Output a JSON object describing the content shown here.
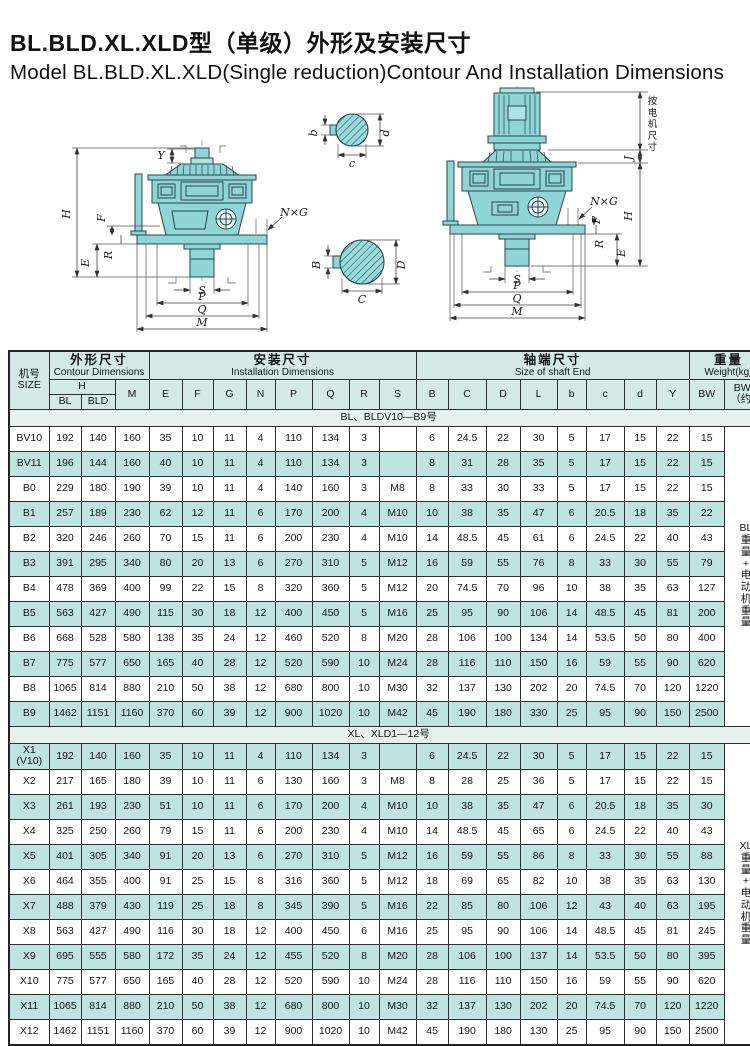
{
  "title": {
    "cn": "BL.BLD.XL.XLD型（单级）外形及安装尺寸",
    "en": "Model BL.BLD.XL.XLD(Single reduction)Contour And Installation Dimensions"
  },
  "drawings": {
    "left_view": {
      "labels": {
        "y": "Y",
        "h": "H",
        "f": "F",
        "r": "R",
        "e": "E",
        "ng": "N×G",
        "s": "S",
        "p": "P",
        "q": "Q",
        "m": "M"
      }
    },
    "right_view": {
      "motor_note_lines": [
        "按",
        "电",
        "机",
        "尺",
        "寸"
      ],
      "labels": {
        "j": "J",
        "h": "H",
        "ng": "N×G",
        "f": "F",
        "r": "R",
        "e": "E",
        "s": "S",
        "p": "P",
        "q": "Q",
        "m": "M"
      }
    },
    "input_shaft_section": {
      "width": "b",
      "diameter": "d",
      "depth": "c"
    },
    "output_shaft_section": {
      "width": "B",
      "diameter": "D",
      "depth": "C"
    }
  },
  "table": {
    "header": {
      "size_cn": "机号",
      "size_en": "SIZE",
      "contour_cn": "外形尺寸",
      "contour_en": "Contour Dimensions",
      "install_cn": "安装尺寸",
      "install_en": "Installation Dimensions",
      "shaft_cn": "轴端尺寸",
      "shaft_en": "Size of shaft End",
      "weight_cn": "重量",
      "weight_en": "Weight(kg)",
      "h": "H",
      "h_bl": "BL",
      "h_bld": "BLD",
      "m": "M",
      "install_cols": [
        "E",
        "F",
        "G",
        "N",
        "P",
        "Q",
        "R",
        "S"
      ],
      "shaft_cols": [
        "B",
        "C",
        "D",
        "L",
        "b",
        "c",
        "d",
        "Y"
      ],
      "bw": "BW",
      "bwd_line1": "BWD",
      "bwd_line2": "（约）"
    },
    "sections": [
      {
        "label": "BL、BLDV10—B9号",
        "stripe": "odd",
        "weight_note_lines": [
          "BL",
          "重",
          "量",
          "+",
          "电",
          "动",
          "机",
          "重",
          "量"
        ],
        "rows": [
          {
            "size": "BV10",
            "values": [
              "192",
              "140",
              "160",
              "35",
              "10",
              "11",
              "4",
              "110",
              "134",
              "3",
              "",
              "6",
              "24.5",
              "22",
              "30",
              "5",
              "17",
              "15",
              "22",
              "15"
            ]
          },
          {
            "size": "BV11",
            "values": [
              "196",
              "144",
              "160",
              "40",
              "10",
              "11",
              "4",
              "110",
              "134",
              "3",
              "",
              "8",
              "31",
              "28",
              "35",
              "5",
              "17",
              "15",
              "22",
              "15"
            ]
          },
          {
            "size": "B0",
            "values": [
              "229",
              "180",
              "190",
              "39",
              "10",
              "11",
              "4",
              "140",
              "160",
              "3",
              "M8",
              "8",
              "33",
              "30",
              "33",
              "5",
              "17",
              "15",
              "22",
              "15"
            ]
          },
          {
            "size": "B1",
            "values": [
              "257",
              "189",
              "230",
              "62",
              "12",
              "11",
              "6",
              "170",
              "200",
              "4",
              "M10",
              "10",
              "38",
              "35",
              "47",
              "6",
              "20.5",
              "18",
              "35",
              "22"
            ]
          },
          {
            "size": "B2",
            "values": [
              "320",
              "246",
              "260",
              "70",
              "15",
              "11",
              "6",
              "200",
              "230",
              "4",
              "M10",
              "14",
              "48.5",
              "45",
              "61",
              "6",
              "24.5",
              "22",
              "40",
              "43"
            ]
          },
          {
            "size": "B3",
            "values": [
              "391",
              "295",
              "340",
              "80",
              "20",
              "13",
              "6",
              "270",
              "310",
              "5",
              "M12",
              "16",
              "59",
              "55",
              "76",
              "8",
              "33",
              "30",
              "55",
              "79"
            ]
          },
          {
            "size": "B4",
            "values": [
              "478",
              "369",
              "400",
              "99",
              "22",
              "15",
              "8",
              "320",
              "360",
              "5",
              "M12",
              "20",
              "74.5",
              "70",
              "96",
              "10",
              "38",
              "35",
              "63",
              "127"
            ]
          },
          {
            "size": "B5",
            "values": [
              "563",
              "427",
              "490",
              "115",
              "30",
              "18",
              "12",
              "400",
              "450",
              "5",
              "M16",
              "25",
              "95",
              "90",
              "106",
              "14",
              "48.5",
              "45",
              "81",
              "200"
            ]
          },
          {
            "size": "B6",
            "values": [
              "668",
              "528",
              "580",
              "138",
              "35",
              "24",
              "12",
              "460",
              "520",
              "8",
              "M20",
              "28",
              "106",
              "100",
              "134",
              "14",
              "53.5",
              "50",
              "80",
              "400"
            ]
          },
          {
            "size": "B7",
            "values": [
              "775",
              "577",
              "650",
              "165",
              "40",
              "28",
              "12",
              "520",
              "590",
              "10",
              "M24",
              "28",
              "116",
              "110",
              "150",
              "16",
              "59",
              "55",
              "90",
              "620"
            ]
          },
          {
            "size": "B8",
            "values": [
              "1065",
              "814",
              "880",
              "210",
              "50",
              "38",
              "12",
              "680",
              "800",
              "10",
              "M30",
              "32",
              "137",
              "130",
              "202",
              "20",
              "74.5",
              "70",
              "120",
              "1220"
            ]
          },
          {
            "size": "B9",
            "values": [
              "1462",
              "1151",
              "1160",
              "370",
              "60",
              "39",
              "12",
              "900",
              "1020",
              "10",
              "M42",
              "45",
              "190",
              "180",
              "330",
              "25",
              "95",
              "90",
              "150",
              "2500"
            ]
          }
        ]
      },
      {
        "label": "XL、XLD1—12号",
        "stripe": "even",
        "weight_note_lines": [
          "XL",
          "重",
          "量",
          "+",
          "电",
          "动",
          "机",
          "重",
          "量"
        ],
        "rows": [
          {
            "size": "X1 (V10)",
            "values": [
              "192",
              "140",
              "160",
              "35",
              "10",
              "11",
              "4",
              "110",
              "134",
              "3",
              "",
              "6",
              "24.5",
              "22",
              "30",
              "5",
              "17",
              "15",
              "22",
              "15"
            ]
          },
          {
            "size": "X2",
            "values": [
              "217",
              "165",
              "180",
              "39",
              "10",
              "11",
              "6",
              "130",
              "160",
              "3",
              "M8",
              "8",
              "28",
              "25",
              "36",
              "5",
              "17",
              "15",
              "22",
              "15"
            ]
          },
          {
            "size": "X3",
            "values": [
              "261",
              "193",
              "230",
              "51",
              "10",
              "11",
              "6",
              "170",
              "200",
              "4",
              "M10",
              "10",
              "38",
              "35",
              "47",
              "6",
              "20.5",
              "18",
              "35",
              "30"
            ]
          },
          {
            "size": "X4",
            "values": [
              "325",
              "250",
              "260",
              "79",
              "15",
              "11",
              "6",
              "200",
              "230",
              "4",
              "M10",
              "14",
              "48.5",
              "45",
              "65",
              "6",
              "24.5",
              "22",
              "40",
              "43"
            ]
          },
          {
            "size": "X5",
            "values": [
              "401",
              "305",
              "340",
              "91",
              "20",
              "13",
              "6",
              "270",
              "310",
              "5",
              "M12",
              "16",
              "59",
              "55",
              "86",
              "8",
              "33",
              "30",
              "55",
              "88"
            ]
          },
          {
            "size": "X6",
            "values": [
              "464",
              "355",
              "400",
              "91",
              "25",
              "15",
              "8",
              "316",
              "360",
              "5",
              "M12",
              "18",
              "69",
              "65",
              "82",
              "10",
              "38",
              "35",
              "63",
              "130"
            ]
          },
          {
            "size": "X7",
            "values": [
              "488",
              "379",
              "430",
              "119",
              "25",
              "18",
              "8",
              "345",
              "390",
              "5",
              "M16",
              "22",
              "85",
              "80",
              "106",
              "12",
              "43",
              "40",
              "63",
              "195"
            ]
          },
          {
            "size": "X8",
            "values": [
              "563",
              "427",
              "490",
              "116",
              "30",
              "18",
              "12",
              "400",
              "450",
              "6",
              "M16",
              "25",
              "95",
              "90",
              "106",
              "14",
              "48.5",
              "45",
              "81",
              "245"
            ]
          },
          {
            "size": "X9",
            "values": [
              "695",
              "555",
              "580",
              "172",
              "35",
              "24",
              "12",
              "455",
              "520",
              "8",
              "M20",
              "28",
              "106",
              "100",
              "137",
              "14",
              "53.5",
              "50",
              "80",
              "395"
            ]
          },
          {
            "size": "X10",
            "values": [
              "775",
              "577",
              "650",
              "165",
              "40",
              "28",
              "12",
              "520",
              "590",
              "10",
              "M24",
              "28",
              "116",
              "110",
              "150",
              "16",
              "59",
              "55",
              "90",
              "620"
            ]
          },
          {
            "size": "X11",
            "values": [
              "1065",
              "814",
              "880",
              "210",
              "50",
              "38",
              "12",
              "680",
              "800",
              "10",
              "M30",
              "32",
              "137",
              "130",
              "202",
              "20",
              "74.5",
              "70",
              "120",
              "1220"
            ]
          },
          {
            "size": "X12",
            "values": [
              "1462",
              "1151",
              "1160",
              "370",
              "60",
              "39",
              "12",
              "900",
              "1020",
              "10",
              "M42",
              "45",
              "190",
              "180",
              "130",
              "25",
              "95",
              "90",
              "150",
              "2500"
            ]
          }
        ]
      }
    ]
  },
  "colors": {
    "table_stripe": "#bfe3de",
    "table_header_bg": "#d3eae6",
    "drawing_fill": "#8fd5d6",
    "border": "#2e2e2e"
  }
}
